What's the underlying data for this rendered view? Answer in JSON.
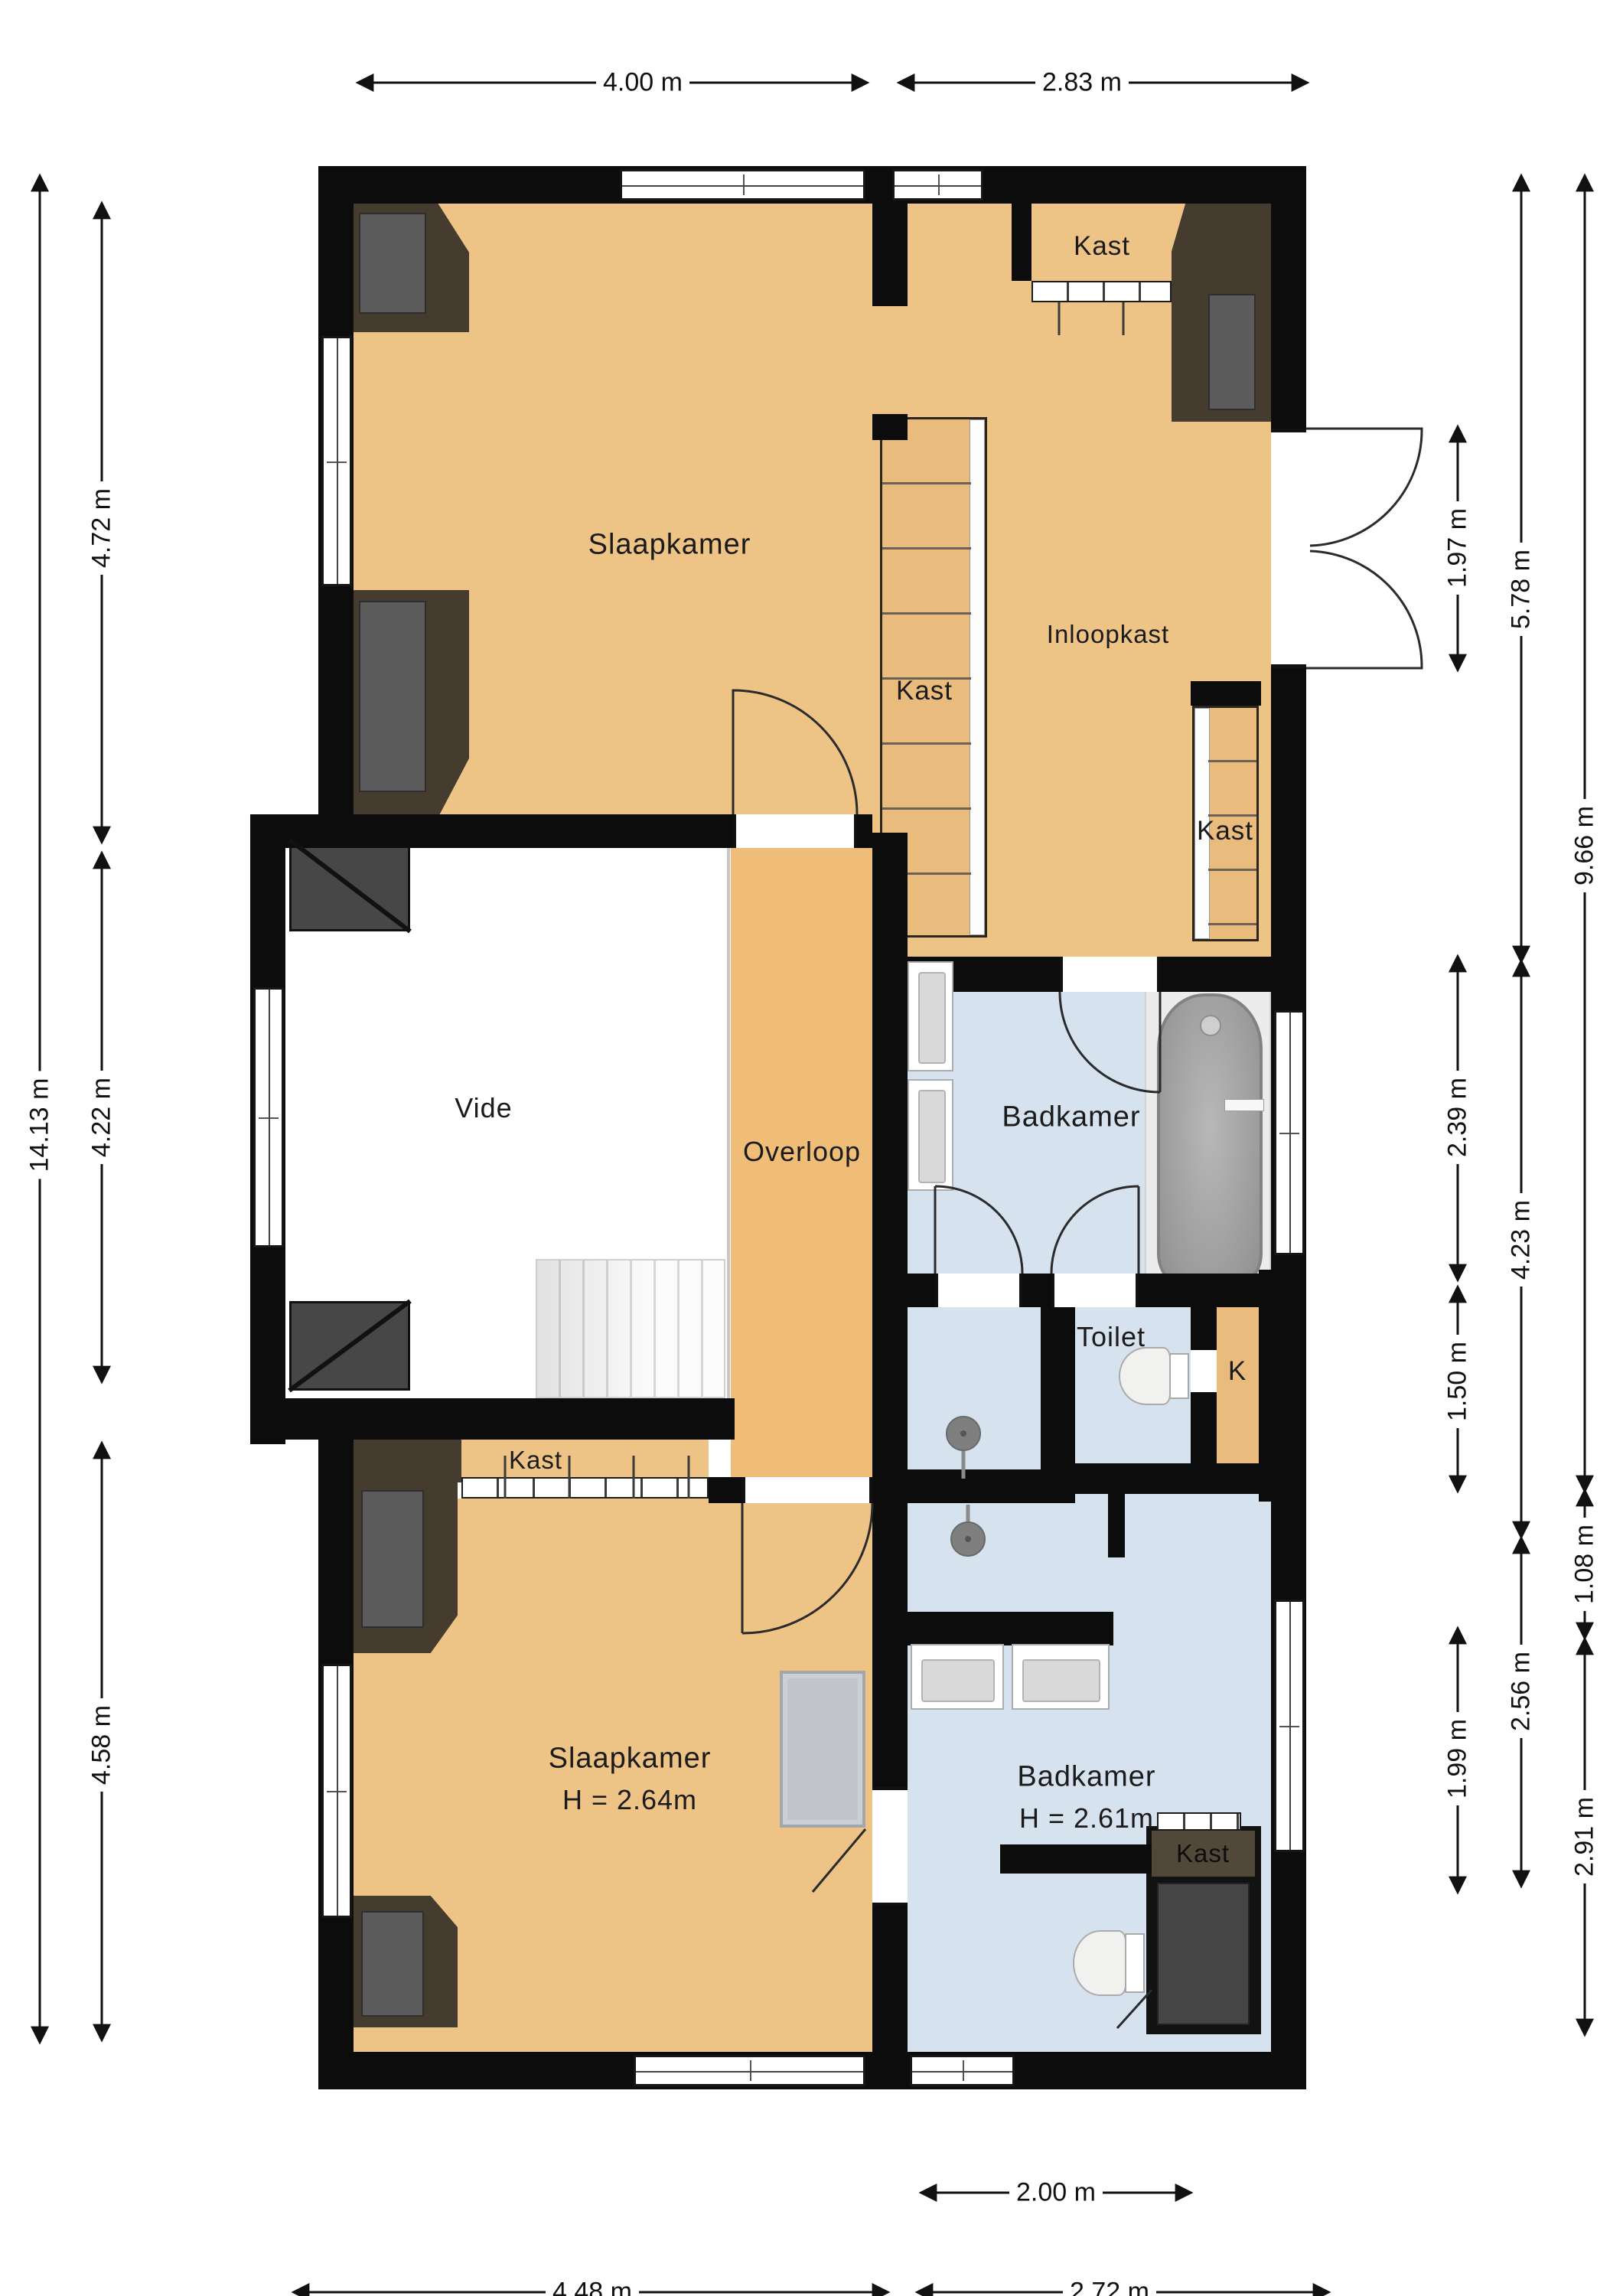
{
  "rooms": {
    "slaapkamer_top": {
      "label": "Slaapkamer"
    },
    "kast_topright": {
      "label": "Kast"
    },
    "inloopkast": {
      "label": "Inloopkast"
    },
    "kast_mid": {
      "label": "Kast"
    },
    "kast_right": {
      "label": "Kast"
    },
    "vide": {
      "label": "Vide"
    },
    "overloop": {
      "label": "Overloop"
    },
    "badkamer_mid": {
      "label": "Badkamer"
    },
    "toilet": {
      "label": "Toilet"
    },
    "k_closet": {
      "label": "K"
    },
    "kast_bottomleft": {
      "label": "Kast"
    },
    "slaapkamer_bottom": {
      "label": "Slaapkamer",
      "height": "H = 2.64m"
    },
    "badkamer_bottom": {
      "label": "Badkamer",
      "height": "H = 2.61m"
    },
    "kast_bottomright": {
      "label": "Kast"
    }
  },
  "dimensions": {
    "top": [
      {
        "label": "4.00 m"
      },
      {
        "label": "2.83 m"
      }
    ],
    "bottom": [
      {
        "label": "2.00 m"
      },
      {
        "label": "4.48 m"
      },
      {
        "label": "2.72 m"
      }
    ],
    "left": [
      {
        "label": "14.13 m"
      },
      {
        "label": "4.72 m"
      },
      {
        "label": "4.22 m"
      },
      {
        "label": "4.58 m"
      }
    ],
    "right_inner": [
      {
        "label": "1.97 m"
      },
      {
        "label": "2.39 m"
      },
      {
        "label": "1.50 m"
      },
      {
        "label": "1.99 m"
      }
    ],
    "right_middle": [
      {
        "label": "5.78 m"
      },
      {
        "label": "4.23 m"
      },
      {
        "label": "2.56 m"
      }
    ],
    "right_outer": [
      {
        "label": "9.66 m"
      },
      {
        "label": "1.08 m"
      },
      {
        "label": "2.91 m"
      }
    ]
  },
  "colors": {
    "floor_bedroom": "#edc386",
    "floor_hall": "#f0bd79",
    "floor_bath": "#d6e2ee",
    "wall": "#0c0c0c",
    "closet_dark": "#453c2f",
    "fixture_gray": "#9c9c9c"
  }
}
